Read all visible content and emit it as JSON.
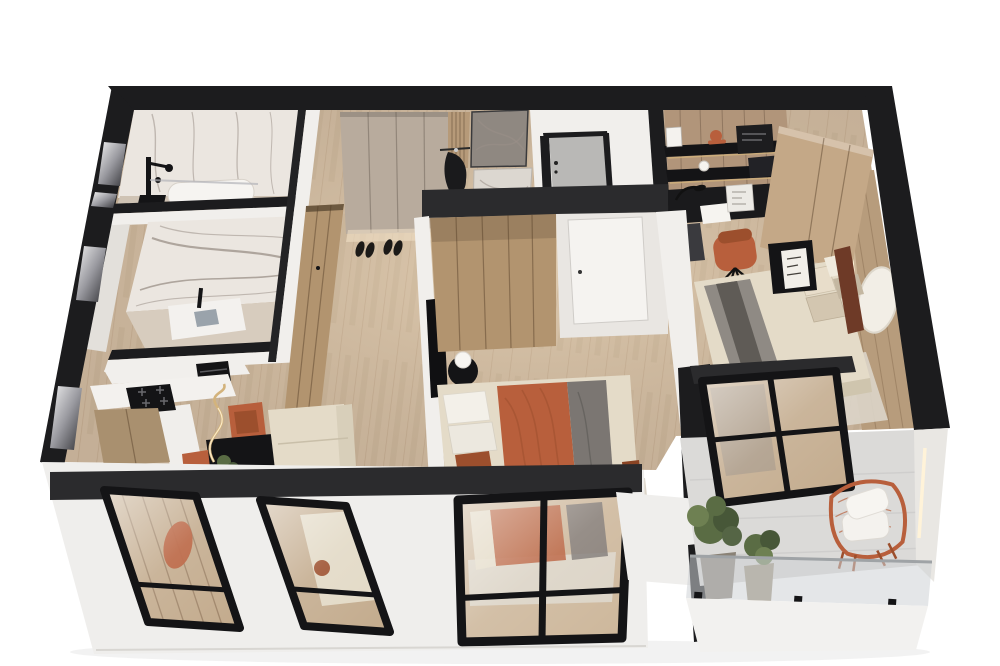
{
  "scene": {
    "description": "3D isometric cutaway render of an apartment floor plan viewed from above, white background, black perimeter walls, light wood floors",
    "view": "axonometric top-down cutaway",
    "background": "#ffffff"
  },
  "palette": {
    "white-bg": "#ffffff",
    "wall": "#1c1c1e",
    "header": "#2b2b2d",
    "floor": "#d0bda6",
    "floorLine": "rgba(120,85,52,0.18)",
    "marble": "#ebe6e0",
    "marbleVein": "#9b9089",
    "whiteWall": "#f1efec",
    "softWall": "#e3e0db",
    "doorGray": "#b9b8b6",
    "taupe": "#b8ab9d",
    "woodCab": "#b2946f",
    "woodSeam": "rgba(82,60,38,0.45)",
    "woodPanel": "#b79c7c",
    "woodLight": "#c4a887",
    "rust": "#b85f3c",
    "rustDeep": "#9c4f2d",
    "cream": "#e4dbc8",
    "creamShade": "#cfc5ae",
    "gray": "#7b7672",
    "rug": "#dcd5c9",
    "black": "#141416",
    "glassWood": "#c3ab8d",
    "glassCool": "rgba(205,210,214,0.55)",
    "balconyFloor": "#dbdad8",
    "exterior": "#efeeec",
    "green": "#5a6c44",
    "greenDk": "#475738",
    "potGray": "#8a8276",
    "potBeige": "#a0947e",
    "gold": "#d3b37c",
    "led": "#fff3d9"
  },
  "rooms": [
    {
      "id": "shower-room",
      "name": "Shower room",
      "features": [
        "marble walls",
        "freestanding bathtub",
        "black shower fixture"
      ]
    },
    {
      "id": "bathroom",
      "name": "Bathroom",
      "features": [
        "marble feature wall",
        "white vanity",
        "black faucet"
      ]
    },
    {
      "id": "kitchen",
      "name": "Kitchen",
      "features": [
        "white counter",
        "black cooktop",
        "built-in appliance"
      ]
    },
    {
      "id": "living-dining",
      "name": "Living / dining room",
      "features": [
        "cream sofa with rust pillow",
        "black dining table",
        "rust dining chairs",
        "gold arc floor lamp",
        "potted plant"
      ]
    },
    {
      "id": "hallway",
      "name": "Entry hallway",
      "features": [
        "taupe wardrobe",
        "shoes",
        "coat rack with black jacket",
        "marble art panels",
        "gray entry door"
      ]
    },
    {
      "id": "bedroom-main",
      "name": "Main bedroom",
      "features": [
        "wood wardrobe",
        "bed with terracotta blanket and gray throw",
        "round black side table",
        "white sphere lamp",
        "terracotta curtains",
        "wall TV"
      ]
    },
    {
      "id": "study",
      "name": "Study nook",
      "features": [
        "black desk and shelves",
        "orange desk lamp",
        "rust office chair",
        "tall wood wardrobe",
        "LED strip",
        "round wall decor"
      ]
    },
    {
      "id": "bedroom-second",
      "name": "Second bedroom",
      "features": [
        "bed with striped gray runner",
        "wood panel headboard wall",
        "black bedside table with art card",
        "glass balcony door"
      ]
    },
    {
      "id": "balcony",
      "name": "Balcony",
      "features": [
        "orange wire lounge chair with white cushions",
        "two potted plants",
        "glass balustrade",
        "vertical light strip"
      ]
    }
  ],
  "openings": {
    "facade_windows": 3,
    "balcony_door_panels": 2,
    "left_wall_niches": 4
  }
}
